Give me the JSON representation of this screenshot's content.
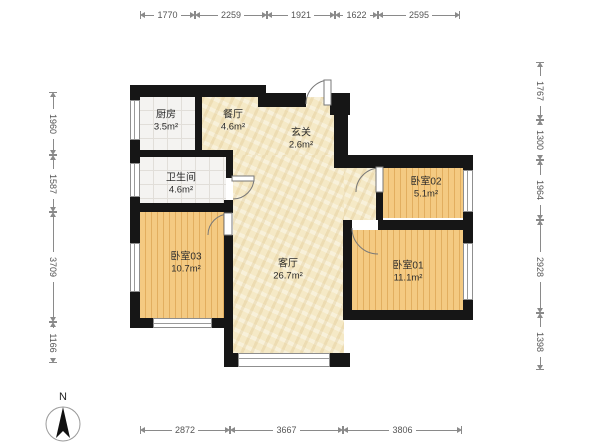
{
  "rooms": {
    "kitchen": {
      "name": "厨房",
      "area": "3.5m²"
    },
    "dining": {
      "name": "餐厅",
      "area": "4.6m²"
    },
    "entry": {
      "name": "玄关",
      "area": "2.6m²"
    },
    "bathroom": {
      "name": "卫生间",
      "area": "4.6m²"
    },
    "bedroom03": {
      "name": "卧室03",
      "area": "10.7m²"
    },
    "living": {
      "name": "客厅",
      "area": "26.7m²"
    },
    "bedroom02": {
      "name": "卧室02",
      "area": "5.1m²"
    },
    "bedroom01": {
      "name": "卧室01",
      "area": "11.1m²"
    }
  },
  "dimensions": {
    "top": [
      "1770",
      "2259",
      "1921",
      "1622",
      "2595"
    ],
    "left": [
      "1960",
      "1587",
      "3709",
      "1166"
    ],
    "right": [
      "1767",
      "1300",
      "1964",
      "2928",
      "1398"
    ],
    "bottom": [
      "2872",
      "3667",
      "3806"
    ]
  },
  "compass": {
    "label": "N"
  },
  "colors": {
    "wall": "#161616",
    "tile_floor": "#f5e9c6",
    "wood_floor": "#f2c67e",
    "wet_floor": "#f4f3f1",
    "dimension_text": "#555555"
  }
}
